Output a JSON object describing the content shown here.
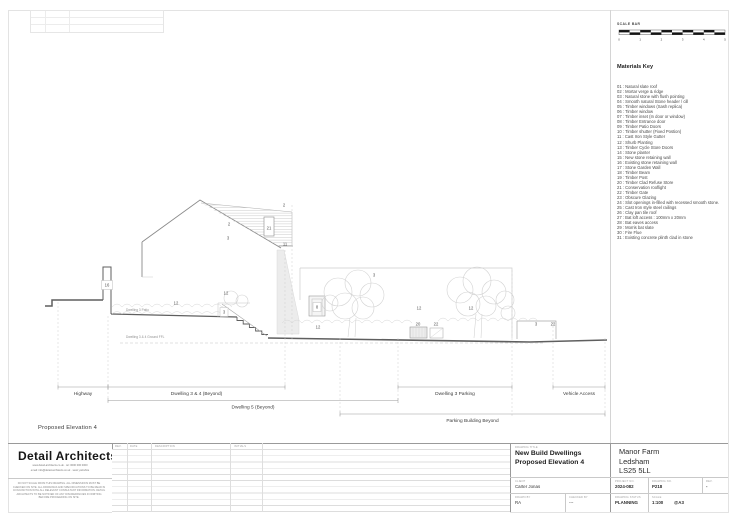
{
  "scale_bar": {
    "label": "SCALE BAR",
    "ticks": [
      "0",
      "1",
      "2",
      "3",
      "4",
      "5"
    ]
  },
  "materials_key": {
    "title": "Materials Key",
    "items": [
      "01 : Natural slate roof",
      "02 : Mortar verge & ridge",
      "03 : Natural stone with flush pointing",
      "04 : Smooth natural Stone header / cill",
      "05 : Timber windows (Sash replica)",
      "06 : Timber window",
      "07 : Timber inset (In door or window)",
      "08 : Timber Entrance door",
      "09 : Timber Patio Doors",
      "10 : Timber shutter (Fixed Postion)",
      "11 : Cast Iron Style Gutter",
      "12 : Shurb Planting",
      "13 : Timber Cycle Store Doors",
      "14 : Stone planter",
      "15 : New stone retaining wall",
      "16 : Existing stone retaining wall",
      "17 : Stone Garden Wall",
      "18 : Timber Beam",
      "19 : Timber Post",
      "20 : Timber Clad Refuse Store",
      "21 : Conservation rooflight",
      "22 : Timber Gate",
      "23 : Obscure Glazing",
      "24 : Slot openings in-filled with recessed smooth stone.",
      "25 : Cast Iron style steel railings",
      "26 : Clay pan tile roof",
      "27 : Bat loft access : 100mm x 20mm",
      "28 : Bat eaves access",
      "29 : Morris bat slate",
      "30 : Fire Flue",
      "31 : Existing concrete plinth clad in stone"
    ]
  },
  "drawing": {
    "title": "Proposed Elevation 4",
    "patio_label": "Dwelling 3 Patio",
    "ffl_label": "Dwelling 3 & 4 Ground FFL",
    "callouts": [
      {
        "n": "2",
        "x": 284,
        "y": 205
      },
      {
        "n": "2",
        "x": 229,
        "y": 224
      },
      {
        "n": "3",
        "x": 228,
        "y": 238
      },
      {
        "n": "21",
        "x": 269,
        "y": 228
      },
      {
        "n": "11",
        "x": 285,
        "y": 244
      },
      {
        "n": "16",
        "x": 107,
        "y": 285,
        "box": true
      },
      {
        "n": "12",
        "x": 176,
        "y": 303
      },
      {
        "n": "12",
        "x": 226,
        "y": 293
      },
      {
        "n": "3",
        "x": 224,
        "y": 312,
        "box": true
      },
      {
        "n": "8",
        "x": 317,
        "y": 307,
        "box": true
      },
      {
        "n": "12",
        "x": 318,
        "y": 327
      },
      {
        "n": "3",
        "x": 374,
        "y": 275
      },
      {
        "n": "12",
        "x": 419,
        "y": 308
      },
      {
        "n": "12",
        "x": 471,
        "y": 308
      },
      {
        "n": "20",
        "x": 418,
        "y": 324
      },
      {
        "n": "22",
        "x": 436,
        "y": 324
      },
      {
        "n": "3",
        "x": 536,
        "y": 324
      },
      {
        "n": "22",
        "x": 553,
        "y": 324
      }
    ],
    "dimensions": [
      {
        "label": "Highway",
        "y": 387,
        "from": 58,
        "to": 108
      },
      {
        "label": "Dwelling 3 & 4 (Beyond)",
        "y": 387,
        "from": 108,
        "to": 285
      },
      {
        "label": "Dwelling 3 Parking",
        "y": 387,
        "from": 398,
        "to": 512
      },
      {
        "label": "Vehicle Access",
        "y": 387,
        "from": 553,
        "to": 605
      },
      {
        "label": "Dwelling 5 (Beyond)",
        "y": 400.5,
        "from": 108,
        "to": 398
      },
      {
        "label": "Parking Building Beyond",
        "y": 414,
        "from": 340,
        "to": 605
      }
    ],
    "guides": [
      {
        "x": 58,
        "y1": 302,
        "y2": 389
      },
      {
        "x": 108,
        "y1": 316,
        "y2": 403
      },
      {
        "x": 285,
        "y1": 250,
        "y2": 389
      },
      {
        "x": 292,
        "y1": 205,
        "y2": 340
      },
      {
        "x": 340,
        "y1": 338,
        "y2": 416
      },
      {
        "x": 398,
        "y1": 338,
        "y2": 403
      },
      {
        "x": 512,
        "y1": 270,
        "y2": 416
      },
      {
        "x": 553,
        "y1": 322,
        "y2": 389
      },
      {
        "x": 605,
        "y1": 338,
        "y2": 416
      }
    ]
  },
  "title_block": {
    "firm": "Detail Architects",
    "contact_line_1": "www.detail-architects.co.uk  ·  tel: 0000 000 0000",
    "contact_line_2": "email: info@detail-architects.co.uk  ·  west yorkshire",
    "disclaimer_lines": [
      "DO NOT SCALE FROM THIS DRAWING. ALL DIMENSIONS MUST BE",
      "CHECKED ON SITE. ALL DRAWINGS AND SPECIFICATIONS TO BE READ IN",
      "CONJUNCTION WITH ALL RELEVANT CONSULTANT INFORMATION. DETAIL",
      "ARCHITECTS TO BE NOTIFIED OF ANY DISCREPANCIES IN WRITING",
      "BEFORE PROCEEDING ON SITE."
    ],
    "revision_table": {
      "headers": [
        "REV.",
        "DATE",
        "DESCRIPTION",
        "INITIALS"
      ]
    },
    "drawing_title": {
      "label": "DRAWING TITLE",
      "line1": "New Build Dwellings",
      "line2": "Proposed Elevation 4"
    },
    "client": {
      "label": "CLIENT",
      "value": "Carter Jonas"
    },
    "drawn_by": {
      "label": "DRAWN BY",
      "value": "RA"
    },
    "checked_by": {
      "label": "CHECKED BY",
      "value": "---"
    },
    "address_lines": [
      "Manor Farm",
      "Ledsham",
      "LS25 5LL"
    ],
    "project_no": {
      "label": "PROJECT NO.",
      "value": "2024-082"
    },
    "drawing_no": {
      "label": "DRAWING NO.",
      "value": "P218"
    },
    "rev": {
      "label": "REV.",
      "value": "-"
    },
    "status": {
      "label": "DRAWING STATUS",
      "value": "PLANNING"
    },
    "scale": {
      "label": "SCALE",
      "value": "1:100",
      "paper": "@A3"
    }
  }
}
